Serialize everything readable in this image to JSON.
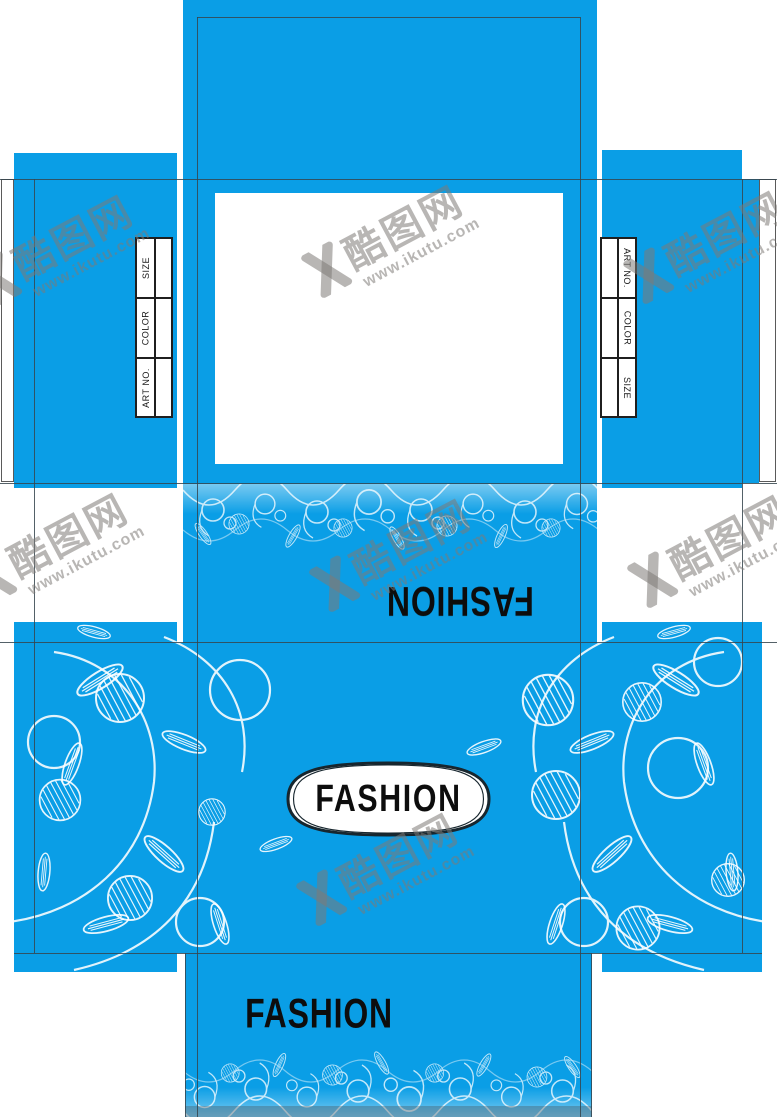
{
  "design": {
    "badge_label": "FASHION",
    "back_panel_label": "FASHION",
    "bottom_flap_label": "FASHION"
  },
  "spec_table": {
    "labels": [
      "ART NO.",
      "COLOR",
      "SIZE"
    ]
  },
  "watermark": {
    "brand_cn": "酷图网",
    "url": "www.ikutu.com"
  },
  "colors": {
    "panel_blue": "#0A9EE6",
    "pattern_white": "#FFFFFF",
    "fold_line": "#36454E",
    "badge_fill": "#FFFFFF",
    "badge_outline": "#17262E",
    "brand_text": "#0D0D0D",
    "watermark_gray": "#7D7A76"
  }
}
